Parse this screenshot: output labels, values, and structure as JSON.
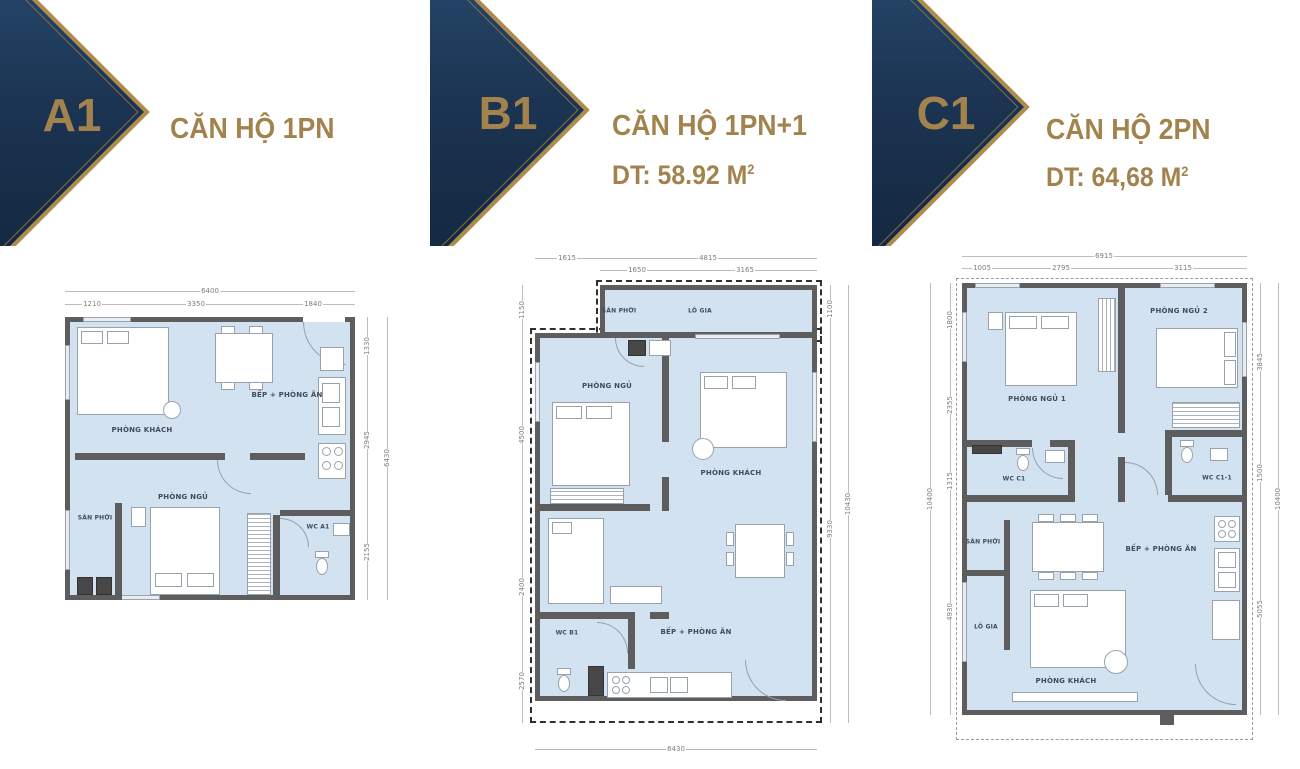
{
  "colors": {
    "navy": "#1c3553",
    "gold": "#ad8a4e",
    "plan_fill": "#d3e2f1",
    "wall": "#5d5d5d"
  },
  "units": [
    {
      "badge": "A1",
      "title": "CĂN HỘ 1PN",
      "area_prefix": "",
      "area_sup": ""
    },
    {
      "badge": "B1",
      "title": "CĂN HỘ 1PN+1",
      "area_prefix": "DT: 58.92 M",
      "area_sup": "2"
    },
    {
      "badge": "C1",
      "title": "CĂN HỘ 2PN",
      "area_prefix": "DT: 64,68 M",
      "area_sup": "2"
    }
  ],
  "plans": [
    {
      "id": "A1",
      "rooms": {
        "living": "PHÒNG KHÁCH",
        "kitchen": "BẾP + PHÒNG ĂN",
        "bedroom": "PHÒNG NGỦ",
        "laundry": "SÂN PHƠI",
        "wc": "WC A1"
      },
      "dims": {
        "top_total": "6400",
        "top_segments": [
          "1210",
          "3350",
          "1840"
        ],
        "right_segments": [
          "1330",
          "2945",
          "2155"
        ],
        "right_total": "6430"
      }
    },
    {
      "id": "B1",
      "rooms": {
        "laundry": "SÂN PHƠI",
        "balcony": "LÔ GIA",
        "bedroom": "PHÒNG NGỦ",
        "living": "PHÒNG KHÁCH",
        "wc": "WC B1",
        "kitchen": "BẾP + PHÒNG ĂN"
      },
      "dims": {
        "top_row1": [
          "1615",
          "4815"
        ],
        "top_row2": [
          "1650",
          "3165"
        ],
        "left_segments": [
          "1150",
          "4500",
          "2400",
          "2570"
        ],
        "right_segments": [
          "1100",
          "9330"
        ],
        "right_total": "10430",
        "bottom_total": "6430"
      }
    },
    {
      "id": "C1",
      "rooms": {
        "bedroom1": "PHÒNG NGỦ 1",
        "bedroom2": "PHÒNG NGỦ 2",
        "wc1": "WC C1",
        "wc2": "WC C1-1",
        "laundry": "SÂN PHƠI",
        "balcony": "LÔ GIA",
        "kitchen": "BẾP + PHÒNG ĂN",
        "living": "PHÒNG KHÁCH"
      },
      "dims": {
        "top_total": "6915",
        "top_segments": [
          "1005",
          "2795",
          "3115"
        ],
        "left_segments": [
          "1800",
          "2355",
          "1315",
          "4930"
        ],
        "left_total": "10400",
        "right_segments": [
          "3845",
          "1500",
          "5055"
        ],
        "right_total": "10400"
      }
    }
  ]
}
